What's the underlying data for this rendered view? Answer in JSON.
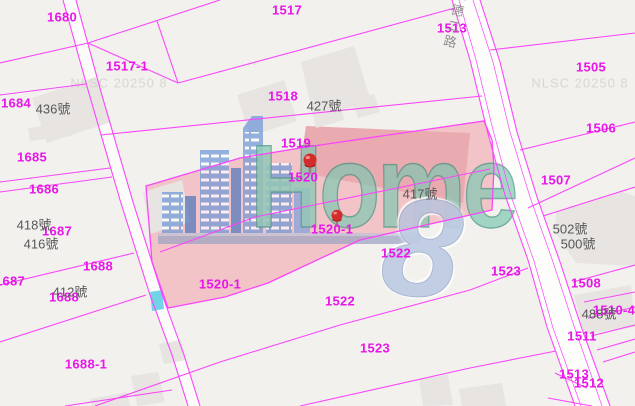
{
  "map": {
    "road_name": "永德二路",
    "watermarks": [
      {
        "text": "NLSC 20250 8",
        "x": 119,
        "y": 83
      },
      {
        "text": "NLSC 20250 8",
        "x": 580,
        "y": 83
      }
    ],
    "parcel_labels": [
      {
        "text": "1680",
        "x": 62,
        "y": 17
      },
      {
        "text": "1517",
        "x": 287,
        "y": 10
      },
      {
        "text": "1513",
        "x": 452,
        "y": 28
      },
      {
        "text": "1517-1",
        "x": 127,
        "y": 66
      },
      {
        "text": "1505",
        "x": 591,
        "y": 67
      },
      {
        "text": "1684",
        "x": 16,
        "y": 103
      },
      {
        "text": "1518",
        "x": 283,
        "y": 96
      },
      {
        "text": "1506",
        "x": 601,
        "y": 128
      },
      {
        "text": "1519",
        "x": 296,
        "y": 143
      },
      {
        "text": "1685",
        "x": 32,
        "y": 157
      },
      {
        "text": "1507",
        "x": 556,
        "y": 180
      },
      {
        "text": "1520",
        "x": 303,
        "y": 177
      },
      {
        "text": "1686",
        "x": 44,
        "y": 189
      },
      {
        "text": "1687",
        "x": 57,
        "y": 231
      },
      {
        "text": "1520-1",
        "x": 332,
        "y": 229
      },
      {
        "text": "1522",
        "x": 396,
        "y": 253
      },
      {
        "text": "1523",
        "x": 506,
        "y": 271
      },
      {
        "text": "1688",
        "x": 98,
        "y": 266
      },
      {
        "text": "1508",
        "x": 586,
        "y": 283
      },
      {
        "text": "1687",
        "x": 10,
        "y": 281
      },
      {
        "text": "1520-1",
        "x": 220,
        "y": 284
      },
      {
        "text": "1688",
        "x": 64,
        "y": 297
      },
      {
        "text": "1522",
        "x": 340,
        "y": 301
      },
      {
        "text": "1510-4",
        "x": 614,
        "y": 310
      },
      {
        "text": "1511",
        "x": 582,
        "y": 336
      },
      {
        "text": "1523",
        "x": 375,
        "y": 348
      },
      {
        "text": "1688-1",
        "x": 86,
        "y": 364
      },
      {
        "text": "1513",
        "x": 574,
        "y": 374
      },
      {
        "text": "1512",
        "x": 589,
        "y": 383
      }
    ],
    "house_labels": [
      {
        "text": "436號",
        "x": 53,
        "y": 108
      },
      {
        "text": "427號",
        "x": 324,
        "y": 105
      },
      {
        "text": "418號",
        "x": 34,
        "y": 224
      },
      {
        "text": "416號",
        "x": 41,
        "y": 243
      },
      {
        "text": "417號",
        "x": 420,
        "y": 193
      },
      {
        "text": "412號",
        "x": 70,
        "y": 291
      },
      {
        "text": "502號",
        "x": 570,
        "y": 228
      },
      {
        "text": "500號",
        "x": 578,
        "y": 243
      },
      {
        "text": "488號",
        "x": 599,
        "y": 313
      }
    ],
    "markers": [
      {
        "name": "pin-1520",
        "x": 310,
        "y": 160
      },
      {
        "name": "pin-1520-1",
        "x": 337,
        "y": 214
      }
    ],
    "colors": {
      "background": "#f2f1ee",
      "parcel_line": "#fa46fa",
      "parcel_text": "#e816e8",
      "highlight_fill": "#f2c4c7",
      "highlight_building": "#eaabb0",
      "building_fill": "#e7e4e2",
      "road_fill": "#fdfdfc",
      "water_cyan": "#72d2e8",
      "watermark_gray": "#d9d6d2",
      "house_text": "#575757",
      "road_text": "#8f8f8f",
      "pin_red": "#d42b2b"
    }
  },
  "logo": {
    "word": "Home",
    "digit": "8",
    "teal": "#7fc7b2",
    "skyline_blue": "#6a94d8",
    "digit_blue": "#b4c4e0"
  }
}
